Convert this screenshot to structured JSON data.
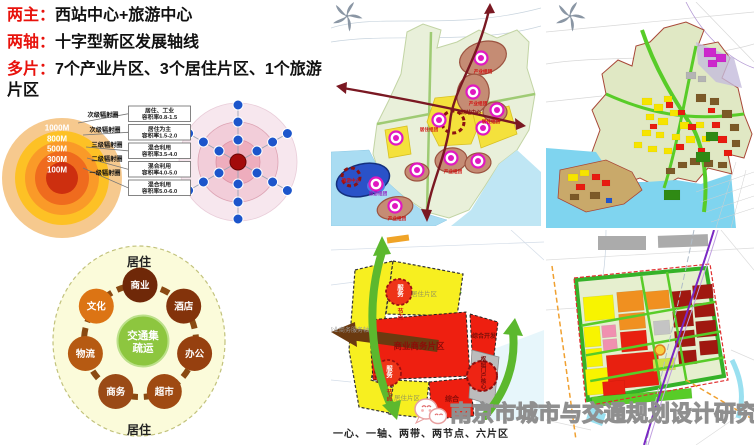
{
  "header": {
    "rows": [
      {
        "label": "两主：",
        "text": "西站中心+旅游中心"
      },
      {
        "label": "两轴：",
        "text": "十字型新区发展轴线"
      },
      {
        "label": "多片：",
        "text": "7个产业片区、3个居住片区、1个旅游片区"
      }
    ]
  },
  "radiation": {
    "rings": [
      "1000M",
      "800M",
      "500M",
      "300M",
      "100M"
    ],
    "tiers": [
      "次级辐射圈",
      "次级辐射圈",
      "三级辐射圈",
      "二级辐射圈",
      "一级辐射圈"
    ],
    "boxes": [
      {
        "use": "居住、工业",
        "far": "容积率0.8-1.5"
      },
      {
        "use": "居住为主",
        "far": "容积率1.5-2.0"
      },
      {
        "use": "混合利用",
        "far": "容积率3.5-4.0"
      },
      {
        "use": "混合利用",
        "far": "容积率4.0-5.0"
      },
      {
        "use": "混合利用",
        "far": "容积率5.0-6.0"
      }
    ]
  },
  "hub": {
    "ring_top": "居住",
    "ring_bottom": "居住",
    "center_top": "交通集",
    "center_bottom": "疏运",
    "nodes": [
      "商业",
      "酒店",
      "办公",
      "超市",
      "商务",
      "物流",
      "文化"
    ],
    "node_colors": [
      "#6f2808",
      "#83330b",
      "#96400f",
      "#9f4a12",
      "#9a4a16",
      "#b65a12",
      "#dc7414"
    ],
    "center_color": "#8dc63f"
  },
  "map1": {
    "station": "西站中心",
    "residential_cluster": "居住组团",
    "industry_cluster": "产业组团",
    "tourism_center": "旅游中心",
    "tourism_cluster": "旅游组团"
  },
  "map3": {
    "business_district": "商业商务片区",
    "comprehensive_dev": "综合开发",
    "hub_core": "枢纽门户核心",
    "service_node_top": "服务",
    "service_node_bottom": "节点",
    "comprehensive": "综合",
    "axis_label": "商业商务服务轴",
    "residential": "居住片区"
  },
  "footer": {
    "watermark": "南京市城市与交通规划设计研究院",
    "caption": "一心、一轴、两带、两节点、六片区"
  },
  "colors": {
    "accent_red": "#e8120c",
    "magenta_node": "#e018c0",
    "axis_dark_red": "#7a1822",
    "hub_green": "#8dc63f"
  }
}
